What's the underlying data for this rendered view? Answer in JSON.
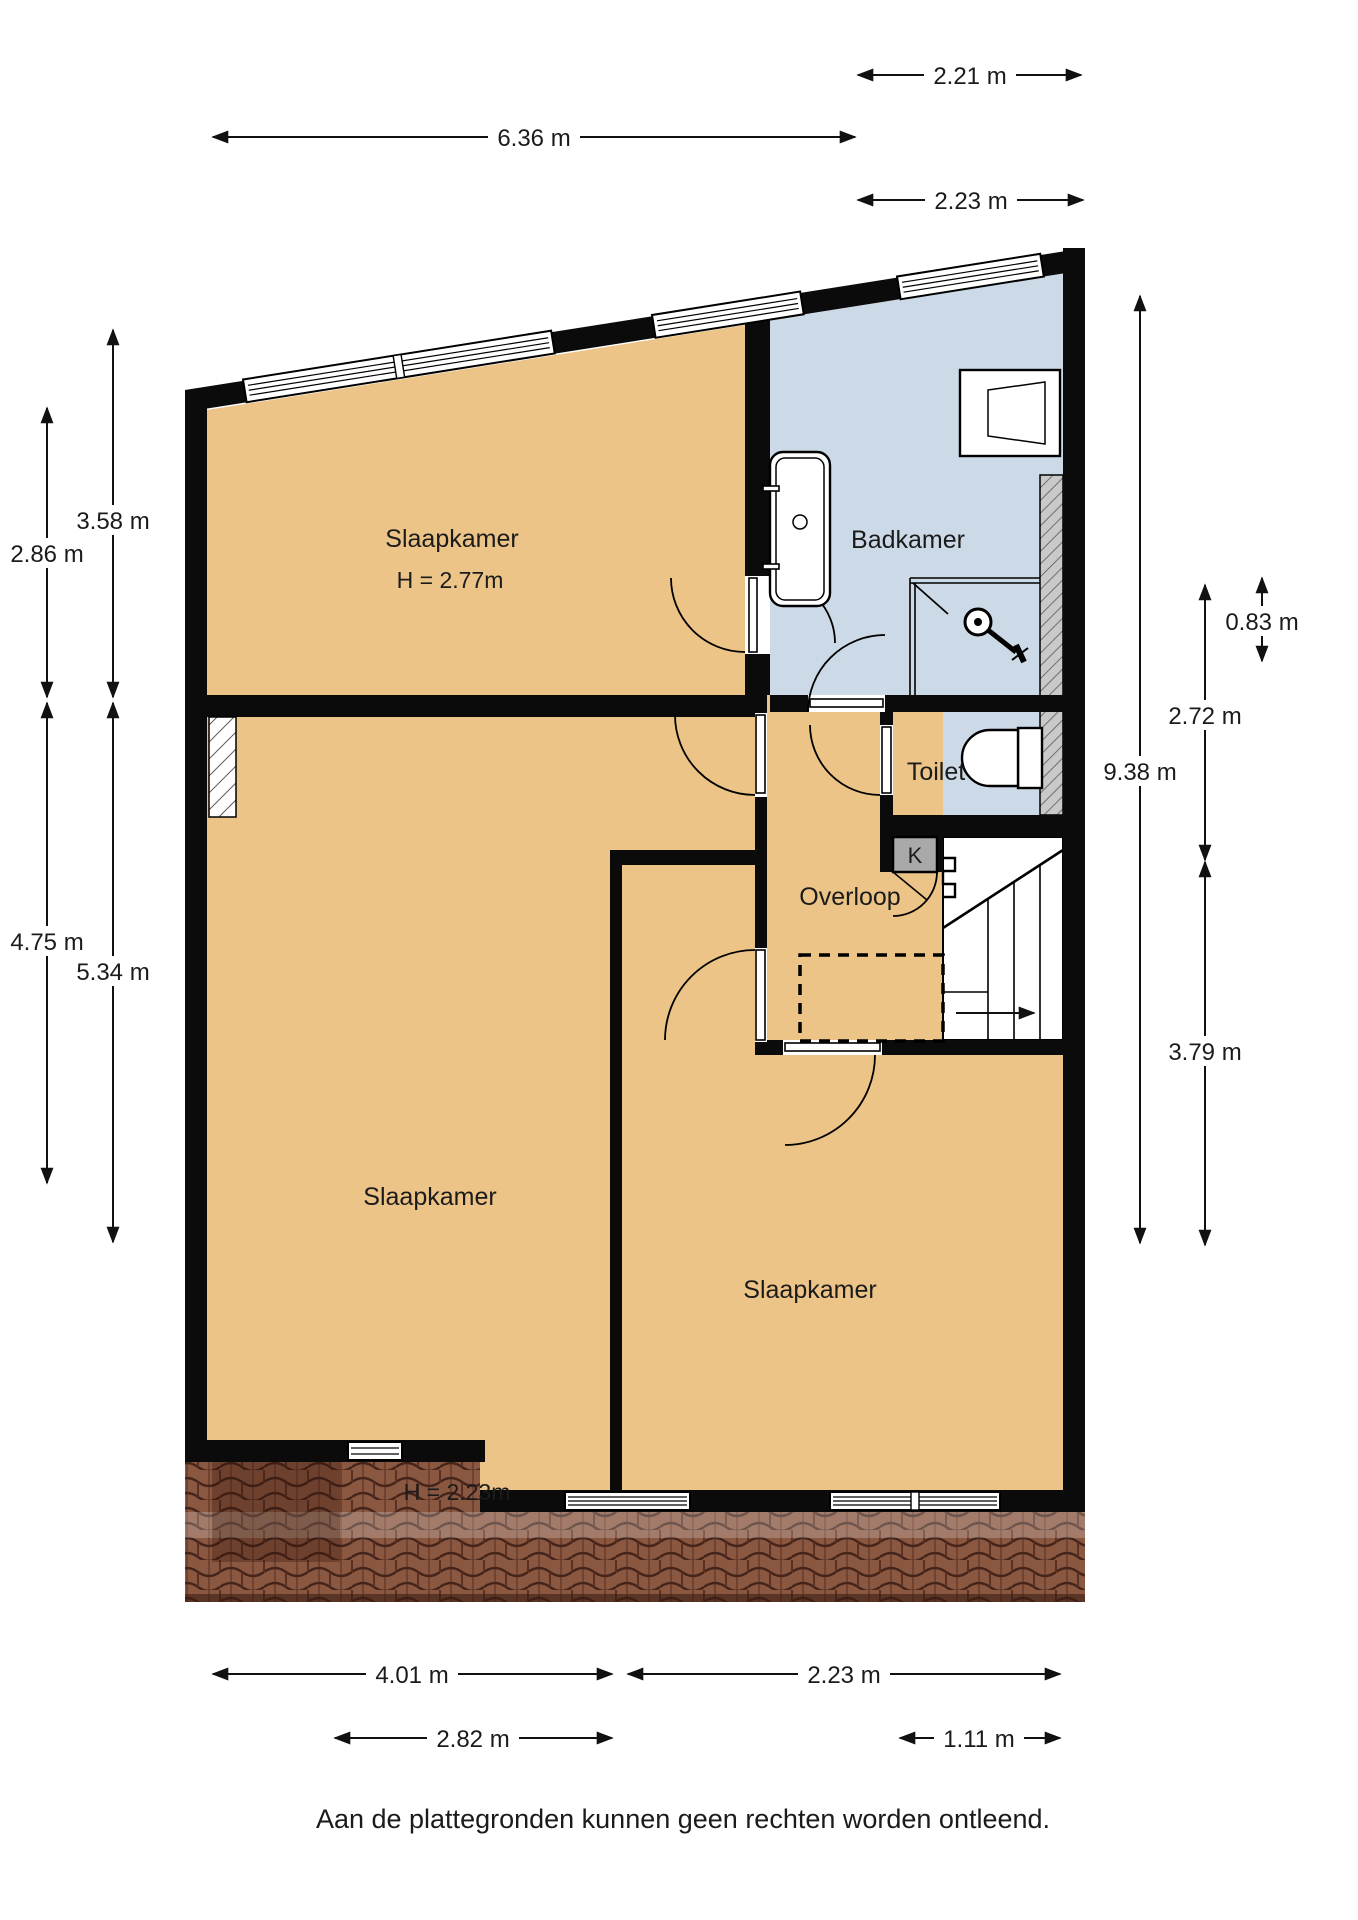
{
  "title": "Plattegrond verdieping",
  "rooms": {
    "slaapkamer_top": {
      "label": "Slaapkamer",
      "height": "H = 2.77m"
    },
    "slaapkamer_mid": {
      "label": "Slaapkamer"
    },
    "slaapkamer_right": {
      "label": "Slaapkamer",
      "height": "H = 2.23m"
    },
    "badkamer": {
      "label": "Badkamer"
    },
    "toilet": {
      "label": "Toilet"
    },
    "overloop": {
      "label": "Overloop"
    },
    "kast": {
      "label": "K"
    }
  },
  "fixtures": [
    "bathtub",
    "sink",
    "shower",
    "toilet-bowl",
    "stairs"
  ],
  "dimensions": {
    "top": [
      "2.21 m",
      "6.36 m",
      "2.23 m"
    ],
    "left": [
      "3.58 m",
      "2.86 m",
      "4.75 m",
      "5.34 m"
    ],
    "right": [
      "9.38 m",
      "0.83 m",
      "2.72 m",
      "3.79 m"
    ],
    "bottom": [
      "4.01 m",
      "2.23 m",
      "2.82 m",
      "1.11 m"
    ]
  },
  "footer": {
    "disclaimer": "Aan de plattegronden kunnen geen rechten worden ontleend."
  },
  "colors": {
    "floor_orange": "#ecc487",
    "floor_blue": "#ccd9e6",
    "wall_black": "#0b0b0b",
    "roof_brick": "#8a5741",
    "shaft_gray": "#c9c9c9",
    "closet_gray": "#a9a9a9",
    "background": "#ffffff"
  }
}
